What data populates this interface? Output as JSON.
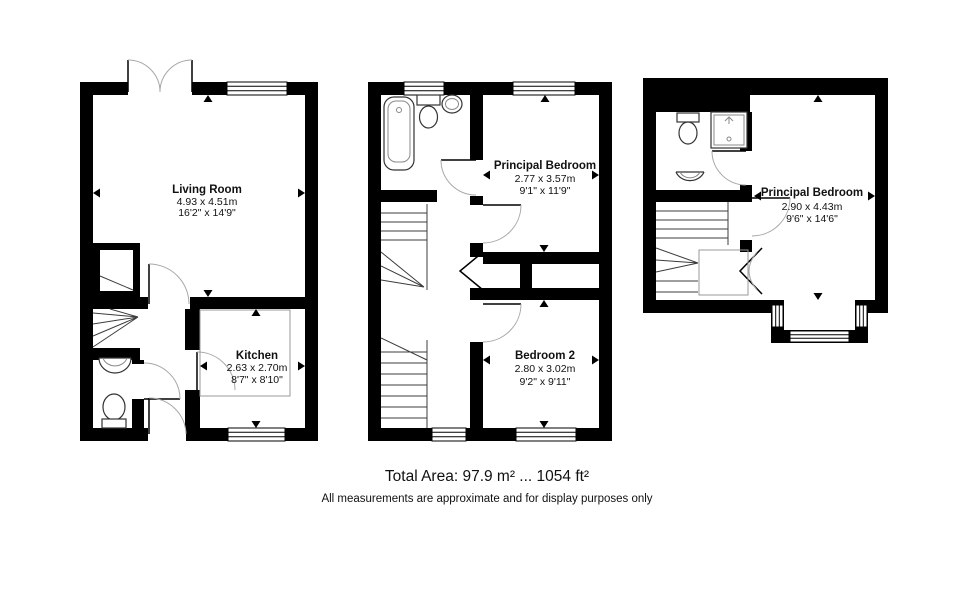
{
  "colors": {
    "background": "#ffffff",
    "wall": "#000000",
    "door_arc": "#a8a8a8",
    "text": "#111111"
  },
  "floors": [
    {
      "id": "ground-floor",
      "rooms": [
        {
          "name": "Living Room",
          "metric": "4.93 x 4.51m",
          "imperial": "16'2\" x 14'9\""
        },
        {
          "name": "Kitchen",
          "metric": "2.63 x 2.70m",
          "imperial": "8'7\" x 8'10\""
        }
      ]
    },
    {
      "id": "first-floor",
      "rooms": [
        {
          "name": "Principal Bedroom",
          "metric": "2.77 x 3.57m",
          "imperial": "9'1\" x 11'9\""
        },
        {
          "name": "Bedroom 2",
          "metric": "2.80 x 3.02m",
          "imperial": "9'2\" x 9'11\""
        }
      ]
    },
    {
      "id": "second-floor",
      "rooms": [
        {
          "name": "Principal Bedroom",
          "metric": "2.90 x 4.43m",
          "imperial": "9'6\" x 14'6\""
        }
      ]
    }
  ],
  "footer": {
    "total_area": "Total Area: 97.9 m² ... 1054 ft²",
    "disclaimer": "All measurements are approximate and for display purposes only"
  }
}
